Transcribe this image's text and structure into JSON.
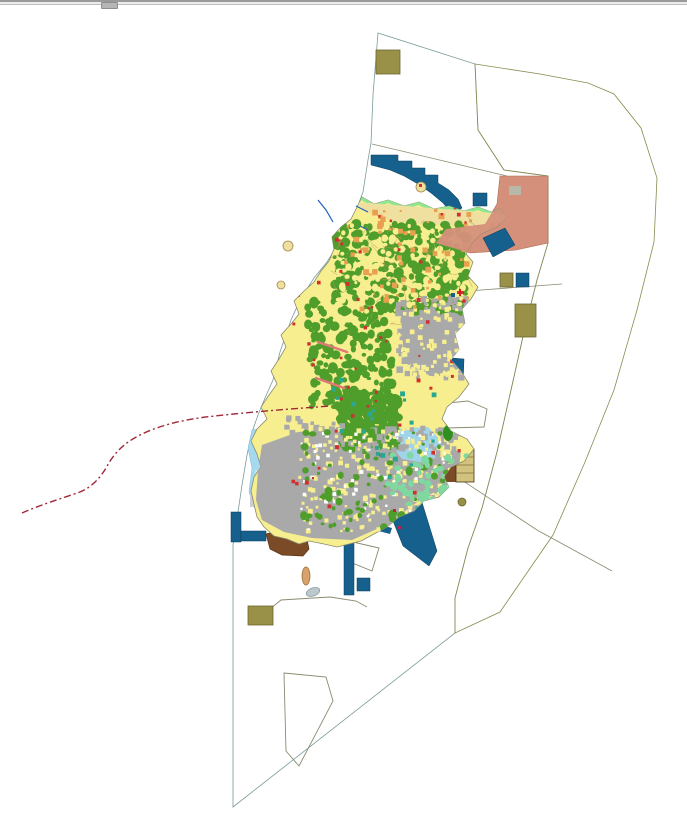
{
  "window": {
    "scrollbar": {
      "orientation": "horizontal",
      "thumb_position_px": 101
    }
  },
  "map": {
    "description": "island-landuse-zoning-map",
    "visible_text": [],
    "palette": {
      "sea_cyan": "#80ffff",
      "buffer_olive": "#cfe57e",
      "island_base": "#f6ee8f",
      "forest_green": "#4f9e2c",
      "forest_dark": "#2f8f1f",
      "urban_gray": "#a9a9a9",
      "coast_green": "#8fe88f",
      "sand": "#f0e0a0",
      "salmon_zone": "#d4907b",
      "harbor_navy": "#15608c",
      "khaki_block": "#9a9148",
      "brown_fill": "#7b4a26",
      "tan_block": "#d2c27e",
      "tan_islet": "#d9a26b",
      "gray_islet": "#bcc8cc",
      "pale_blue_flats": "#a6d9ee",
      "pale_blue_delta": "#9fd4ea",
      "flat_gray_patch": "#c9cdd0",
      "lowland_green": "#7fd8a0",
      "orange_patch": "#e8a050",
      "red_mark": "#d03030",
      "crimson_mark": "#c02050",
      "teal_mark": "#28a890",
      "parcel_line": "#c09858",
      "boundary_line": "#8a8a70",
      "dashed_red_line": "#a02838",
      "river_blue": "#2060c0",
      "road_pink": "#e07878",
      "white": "#ffffff"
    },
    "features": [
      {
        "id": "coastal-water-zone",
        "shape": "polygon",
        "color_key": "sea_cyan"
      },
      {
        "id": "offshore-buffer-zone",
        "shape": "polygon",
        "color_key": "buffer_olive"
      },
      {
        "id": "island-landmass",
        "shape": "polygon",
        "color_key": "island_base"
      },
      {
        "id": "north-salmon-zone",
        "shape": "polygon",
        "color_key": "salmon_zone"
      },
      {
        "id": "north-breakwater",
        "shape": "stepped-band",
        "color_key": "harbor_navy"
      },
      {
        "id": "east-harbor-basin",
        "shape": "rect",
        "color_key": "harbor_navy"
      },
      {
        "id": "southeast-pier",
        "shape": "polygon",
        "color_key": "harbor_navy"
      },
      {
        "id": "south-piers",
        "shape": "rects",
        "color_key": "harbor_navy"
      },
      {
        "id": "khaki-reserved-blocks",
        "shape": "rects",
        "color_key": "khaki_block"
      },
      {
        "id": "southwest-reclaimed-fill",
        "shape": "polygon",
        "color_key": "brown_fill"
      },
      {
        "id": "west-tidal-flats",
        "shape": "polygon",
        "color_key": "pale_blue_flats"
      },
      {
        "id": "planned-area-outlines",
        "shape": "outlines",
        "color_key": "boundary_line"
      },
      {
        "id": "dashed-boundary-line",
        "shape": "polyline",
        "color_key": "dashed_red_line"
      }
    ]
  }
}
